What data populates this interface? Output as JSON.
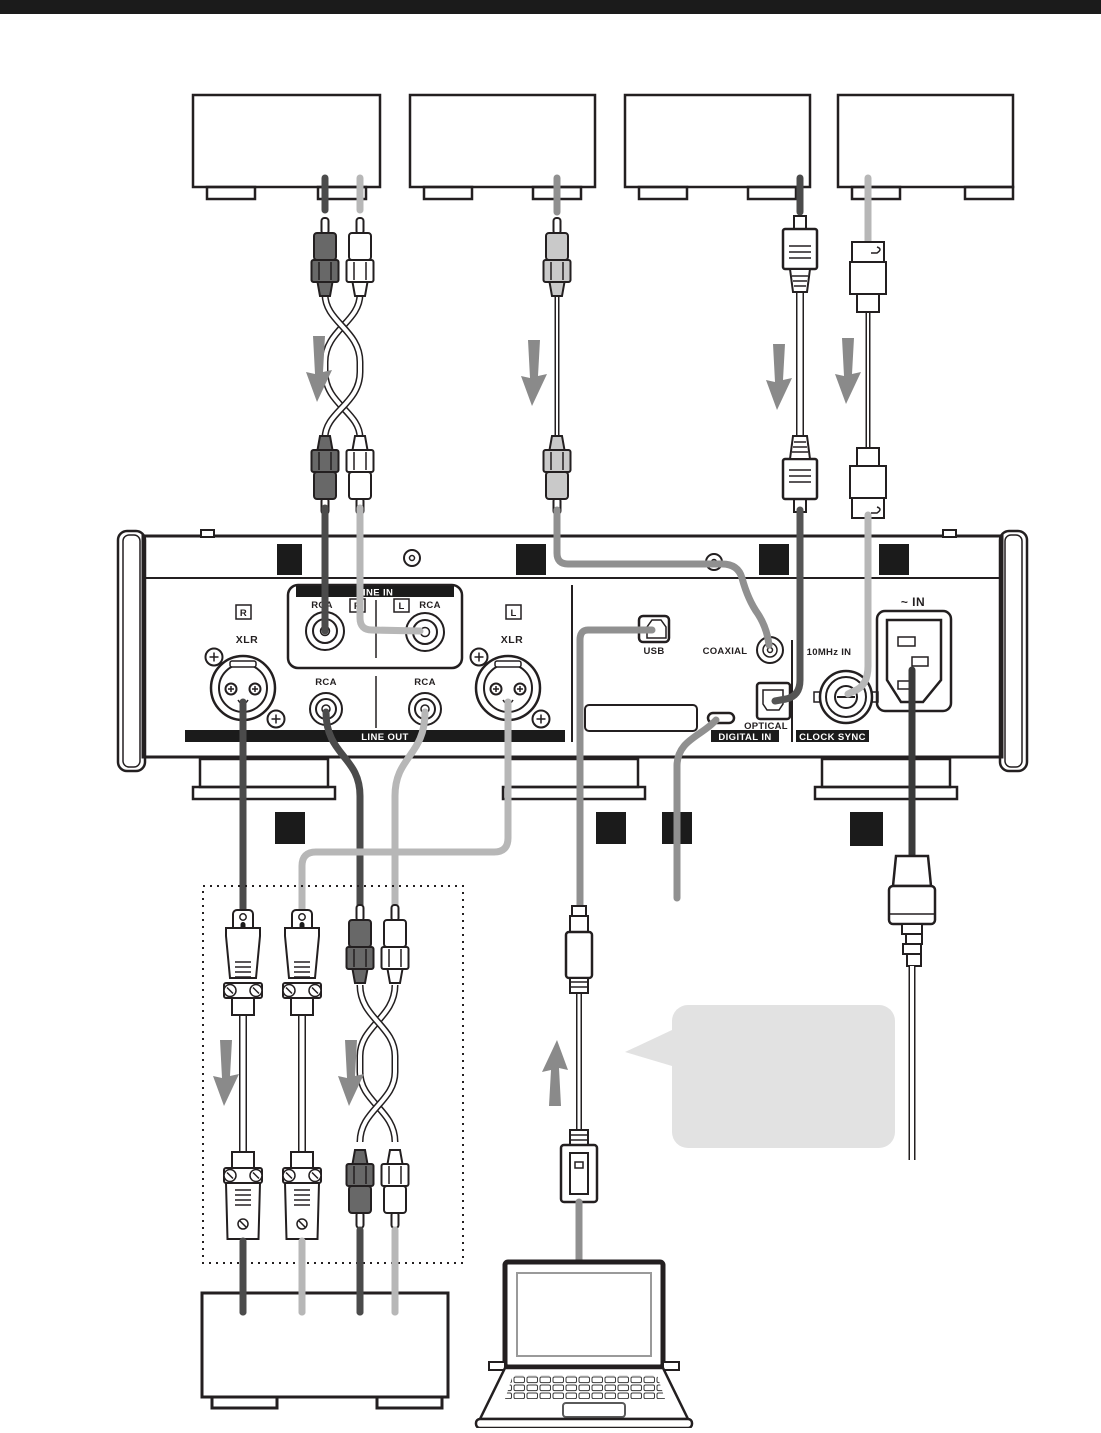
{
  "colors": {
    "line": "#231f20",
    "bar": "#1b1b1b",
    "cable_dark": "#4b4b4b",
    "cable_light": "#b7b7b7",
    "cable_mid": "#909090",
    "cable_ac": "#3a3a3a",
    "cable_optical": "#555555",
    "arrow": "#8a8a8a",
    "bubble": "#e2e2e2",
    "plug_dark": "#686868",
    "plug_gray": "#c9c9c9"
  },
  "rear_panel": {
    "line_in": {
      "label": "LINE IN",
      "jack_left_type": "RCA",
      "jack_left_channel": "R",
      "jack_right_type": "RCA",
      "jack_right_channel": "L"
    },
    "line_out": {
      "label": "LINE OUT",
      "xlr_label": "XLR",
      "rca_label": "RCA",
      "channel_r": "R",
      "channel_l": "L"
    },
    "digital_in": {
      "label": "DIGITAL IN",
      "usb_label": "USB",
      "coaxial_label": "COAXIAL",
      "optical_label": "OPTICAL"
    },
    "clock_sync": {
      "label": "CLOCK SYNC",
      "bnc_label": "10MHz IN"
    },
    "power": {
      "ac_in_label": "~ IN"
    }
  }
}
